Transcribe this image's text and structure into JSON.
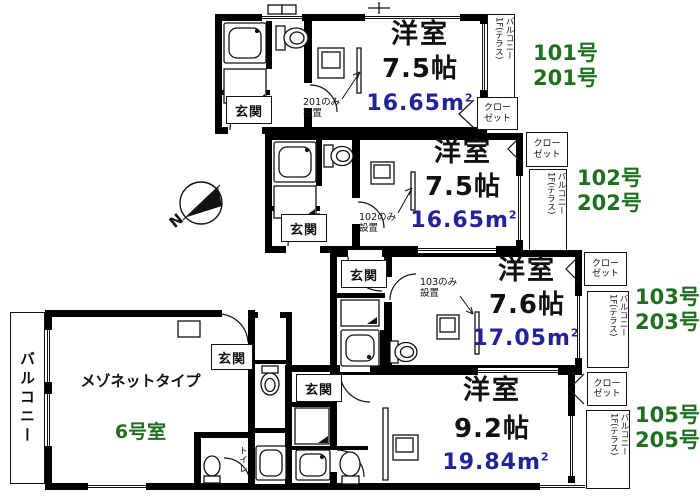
{
  "colors": {
    "wall": "#000000",
    "unit_number_green": "#1e701e",
    "area_navy": "#22229b",
    "ink": "#111111"
  },
  "north": {
    "label": "N"
  },
  "units": [
    {
      "numbers": [
        "101号",
        "201号"
      ],
      "room_type": "洋室",
      "room_size": "7.5帖",
      "area_value": "16.65m",
      "area_sup": "2",
      "entrance": "玄関",
      "note_line1": "201のみ",
      "note_line2": "設置",
      "closet_line1": "クロー",
      "closet_line2": "ゼット",
      "balcony_col1": "バルコニー",
      "balcony_col2": "1F(テラス)"
    },
    {
      "numbers": [
        "102号",
        "202号"
      ],
      "room_type": "洋室",
      "room_size": "7.5帖",
      "area_value": "16.65m",
      "area_sup": "2",
      "entrance": "玄関",
      "note_line1": "102のみ",
      "note_line2": "設置",
      "closet_line1": "クロー",
      "closet_line2": "ゼット",
      "balcony_col1": "バルコニー",
      "balcony_col2": "1F(テラス)"
    },
    {
      "numbers": [
        "103号",
        "203号"
      ],
      "room_type": "洋室",
      "room_size": "7.6帖",
      "area_value": "17.05m",
      "area_sup": "2",
      "entrance": "玄関",
      "note_line1": "103のみ",
      "note_line2": "設置",
      "closet_line1": "クロー",
      "closet_line2": "ゼット",
      "balcony_col1": "バルコニー",
      "balcony_col2": "1F(テラス)"
    },
    {
      "numbers": [
        "105号",
        "205号"
      ],
      "room_type": "洋室",
      "room_size": "9.2帖",
      "area_value": "19.84m",
      "area_sup": "2",
      "entrance": "玄関",
      "closet_line1": "クロー",
      "closet_line2": "ゼット",
      "balcony_col1": "バルコニー",
      "balcony_col2": "1F(テラス)"
    }
  ],
  "maisonette": {
    "type_label": "メゾネットタイプ",
    "number": "6号室",
    "balcony": "バルコニー",
    "entrance": "玄関",
    "toilet": "トイレ"
  }
}
